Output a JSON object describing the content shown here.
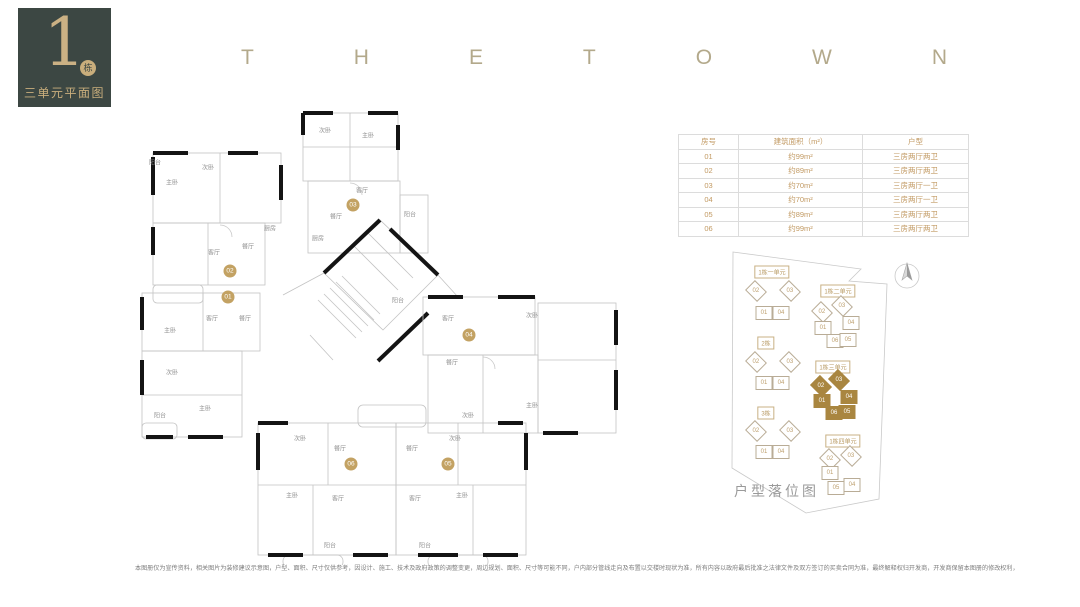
{
  "badge": {
    "number": "1",
    "suffix": "栋",
    "subtitle": "三单元平面图"
  },
  "title": {
    "letters": [
      "T",
      "H",
      "E",
      "T",
      "O",
      "W",
      "N"
    ]
  },
  "table": {
    "headers": [
      "房号",
      "建筑面积（m²）",
      "户型"
    ],
    "rows": [
      [
        "01",
        "约99m²",
        "三房两厅两卫"
      ],
      [
        "02",
        "约89m²",
        "三房两厅两卫"
      ],
      [
        "03",
        "约70m²",
        "三房两厅一卫"
      ],
      [
        "04",
        "约70m²",
        "三房两厅一卫"
      ],
      [
        "05",
        "约89m²",
        "三房两厅两卫"
      ],
      [
        "06",
        "约99m²",
        "三房两厅两卫"
      ]
    ]
  },
  "floorplan": {
    "unit_badges": [
      {
        "label": "02",
        "x": 230,
        "y": 271
      },
      {
        "label": "01",
        "x": 228,
        "y": 297
      },
      {
        "label": "03",
        "x": 353,
        "y": 205
      },
      {
        "label": "04",
        "x": 469,
        "y": 335
      },
      {
        "label": "06",
        "x": 351,
        "y": 464
      },
      {
        "label": "05",
        "x": 448,
        "y": 464
      }
    ],
    "room_labels": [
      {
        "t": "阳台",
        "x": 155,
        "y": 162
      },
      {
        "t": "次卧",
        "x": 208,
        "y": 167
      },
      {
        "t": "主卧",
        "x": 172,
        "y": 182
      },
      {
        "t": "客厅",
        "x": 214,
        "y": 252
      },
      {
        "t": "餐厅",
        "x": 248,
        "y": 246
      },
      {
        "t": "厨房",
        "x": 270,
        "y": 228
      },
      {
        "t": "主卧",
        "x": 170,
        "y": 330
      },
      {
        "t": "客厅",
        "x": 212,
        "y": 318
      },
      {
        "t": "餐厅",
        "x": 245,
        "y": 318
      },
      {
        "t": "次卧",
        "x": 172,
        "y": 372
      },
      {
        "t": "主卧",
        "x": 205,
        "y": 408
      },
      {
        "t": "阳台",
        "x": 160,
        "y": 415
      },
      {
        "t": "次卧",
        "x": 325,
        "y": 130
      },
      {
        "t": "主卧",
        "x": 368,
        "y": 135
      },
      {
        "t": "客厅",
        "x": 362,
        "y": 190
      },
      {
        "t": "餐厅",
        "x": 336,
        "y": 216
      },
      {
        "t": "阳台",
        "x": 410,
        "y": 214
      },
      {
        "t": "厨房",
        "x": 318,
        "y": 238
      },
      {
        "t": "客厅",
        "x": 448,
        "y": 318
      },
      {
        "t": "次卧",
        "x": 532,
        "y": 315
      },
      {
        "t": "餐厅",
        "x": 452,
        "y": 362
      },
      {
        "t": "主卧",
        "x": 532,
        "y": 405
      },
      {
        "t": "次卧",
        "x": 468,
        "y": 415
      },
      {
        "t": "阳台",
        "x": 398,
        "y": 300
      },
      {
        "t": "次卧",
        "x": 300,
        "y": 438
      },
      {
        "t": "餐厅",
        "x": 340,
        "y": 448
      },
      {
        "t": "主卧",
        "x": 292,
        "y": 495
      },
      {
        "t": "客厅",
        "x": 338,
        "y": 498
      },
      {
        "t": "阳台",
        "x": 330,
        "y": 545
      },
      {
        "t": "餐厅",
        "x": 412,
        "y": 448
      },
      {
        "t": "次卧",
        "x": 455,
        "y": 438
      },
      {
        "t": "客厅",
        "x": 415,
        "y": 498
      },
      {
        "t": "主卧",
        "x": 462,
        "y": 495
      },
      {
        "t": "阳台",
        "x": 425,
        "y": 545
      }
    ]
  },
  "siteplan": {
    "caption": "户型落位图",
    "clusters": [
      {
        "label": "1栋一单元",
        "lx": 772,
        "ly": 272,
        "hl": false,
        "units": [
          {
            "n": "02",
            "x": 756,
            "y": 291,
            "r": 1
          },
          {
            "n": "03",
            "x": 790,
            "y": 291,
            "r": 1
          },
          {
            "n": "01",
            "x": 764,
            "y": 313,
            "r": 0
          },
          {
            "n": "04",
            "x": 781,
            "y": 313,
            "r": 0
          }
        ]
      },
      {
        "label": "1栋二单元",
        "lx": 838,
        "ly": 291,
        "hl": false,
        "units": [
          {
            "n": "02",
            "x": 822,
            "y": 312,
            "r": 1
          },
          {
            "n": "03",
            "x": 842,
            "y": 306,
            "r": 1
          },
          {
            "n": "01",
            "x": 823,
            "y": 328,
            "r": 0
          },
          {
            "n": "04",
            "x": 851,
            "y": 323,
            "r": 0
          },
          {
            "n": "06",
            "x": 835,
            "y": 341,
            "r": 0
          },
          {
            "n": "05",
            "x": 848,
            "y": 340,
            "r": 0
          }
        ]
      },
      {
        "label": "2栋",
        "lx": 766,
        "ly": 343,
        "hl": false,
        "units": [
          {
            "n": "02",
            "x": 756,
            "y": 362,
            "r": 1
          },
          {
            "n": "03",
            "x": 790,
            "y": 362,
            "r": 1
          },
          {
            "n": "01",
            "x": 764,
            "y": 383,
            "r": 0
          },
          {
            "n": "04",
            "x": 781,
            "y": 383,
            "r": 0
          }
        ]
      },
      {
        "label": "1栋三单元",
        "lx": 833,
        "ly": 367,
        "hl": true,
        "units": [
          {
            "n": "02",
            "x": 821,
            "y": 386,
            "r": 1
          },
          {
            "n": "03",
            "x": 839,
            "y": 380,
            "r": 1
          },
          {
            "n": "01",
            "x": 822,
            "y": 401,
            "r": 0
          },
          {
            "n": "04",
            "x": 849,
            "y": 397,
            "r": 0
          },
          {
            "n": "06",
            "x": 834,
            "y": 413,
            "r": 0
          },
          {
            "n": "05",
            "x": 847,
            "y": 412,
            "r": 0
          }
        ]
      },
      {
        "label": "3栋",
        "lx": 766,
        "ly": 413,
        "hl": false,
        "units": [
          {
            "n": "02",
            "x": 756,
            "y": 431,
            "r": 1
          },
          {
            "n": "03",
            "x": 790,
            "y": 431,
            "r": 1
          },
          {
            "n": "01",
            "x": 764,
            "y": 452,
            "r": 0
          },
          {
            "n": "04",
            "x": 781,
            "y": 452,
            "r": 0
          }
        ]
      },
      {
        "label": "1栋四单元",
        "lx": 843,
        "ly": 441,
        "hl": false,
        "units": [
          {
            "n": "02",
            "x": 830,
            "y": 459,
            "r": 1
          },
          {
            "n": "03",
            "x": 851,
            "y": 456,
            "r": 1
          },
          {
            "n": "01",
            "x": 830,
            "y": 473,
            "r": 0
          },
          {
            "n": "05",
            "x": 836,
            "y": 488,
            "r": 0
          },
          {
            "n": "04",
            "x": 852,
            "y": 485,
            "r": 0
          }
        ]
      }
    ]
  },
  "footer": {
    "disclaimer": "本图册仅为宣传资料，相关图片为装修建议示意图，户型、面积、尺寸仅供参考，因设计、施工、技术及政府政策的调整变更，周边规划、面积、尺寸等可能不同，户内部分管线走向及布置以交楼时现状为准，所有内容以政府最后批准之法律文件及双方签订的买卖合同为准，最终解释权归开发商，开发商保留本图册的修改权利，敬请留意最新资料。"
  },
  "colors": {
    "accent_gold": "#c2a571",
    "badge_bg": "#3c4743",
    "highlight": "#a98640",
    "wall": "#141414",
    "thin_line": "#c3c3c3",
    "table_text": "#c29a63"
  }
}
